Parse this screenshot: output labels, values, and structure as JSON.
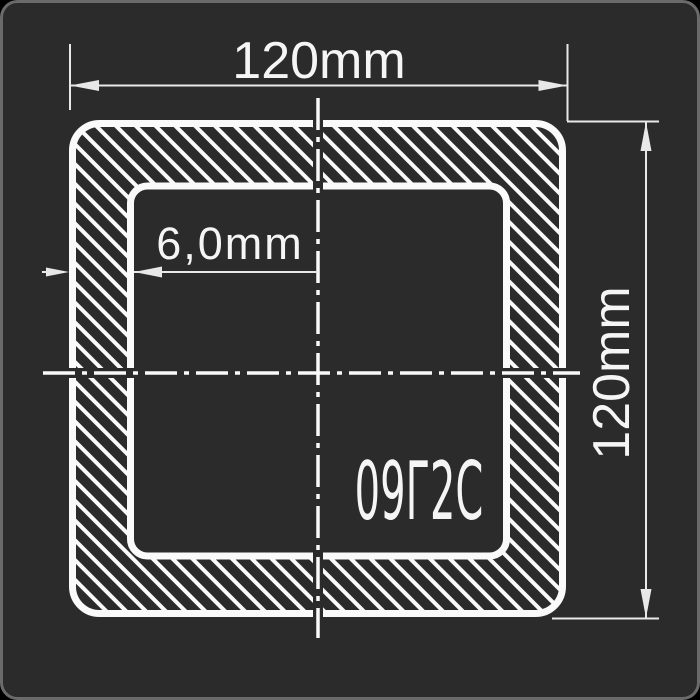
{
  "drawing": {
    "type": "square-hollow-section-cross-section",
    "labels": {
      "top_dimension": "120mm",
      "right_dimension": "120mm",
      "wall_thickness": "6,0mm",
      "steel_grade": "09Г2С"
    },
    "colors": {
      "canvas_outside": "#000000",
      "panel_background": "#2b2b2b",
      "panel_border": "#6a6a6a",
      "contour": "#fafafa",
      "thin_line": "#e8e8e8",
      "text": "#f5f5f5"
    }
  }
}
